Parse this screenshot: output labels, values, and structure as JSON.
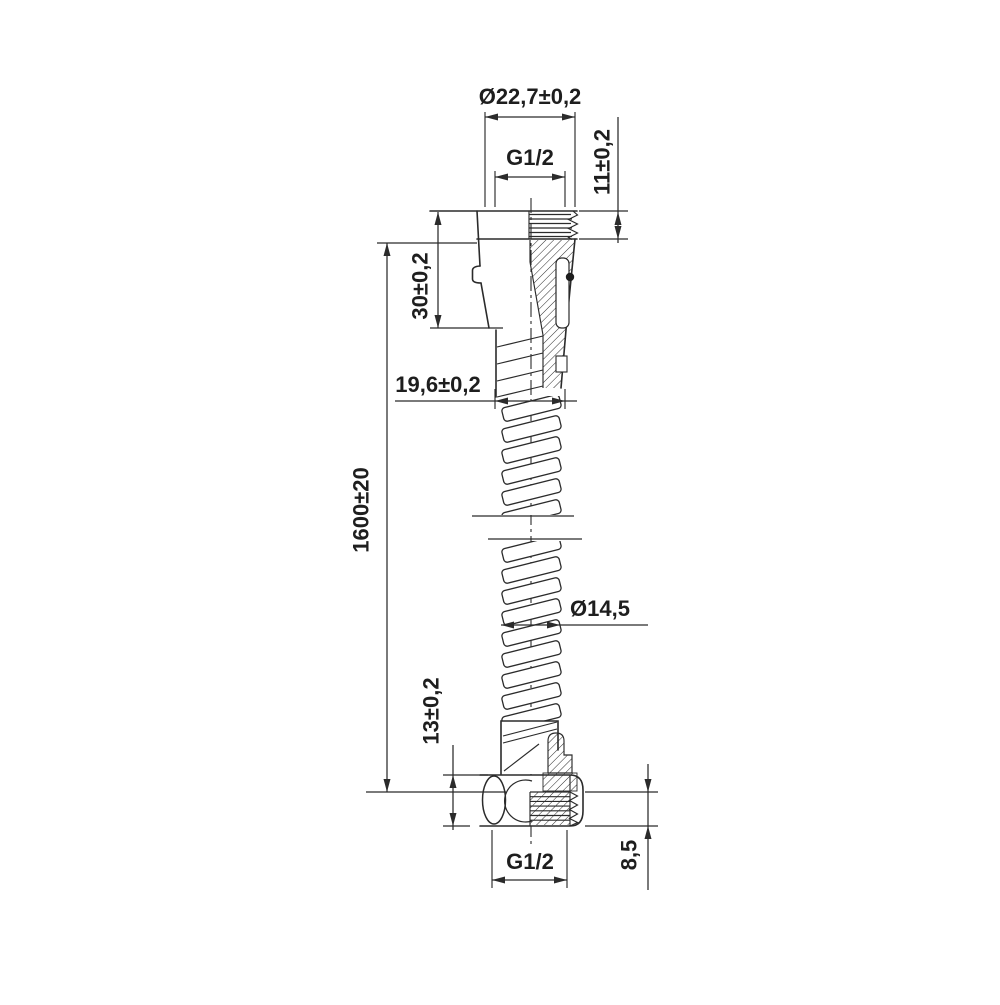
{
  "drawing": {
    "type": "technical-dimension-drawing",
    "subject": "flexible shower hose with end fittings, half-section view",
    "background_color": "#ffffff",
    "line_color": "#2b2b2b",
    "labels": {
      "top_outer_diameter": "Ø22,7±0,2",
      "top_thread": "G1/2",
      "top_thread_length": "11±0,2",
      "top_fitting_length": "30±0,2",
      "ferrule_diameter": "19,6±0,2",
      "overall_length": "1600±20",
      "hose_diameter": "Ø14,5",
      "bottom_fitting_height": "13±0,2",
      "bottom_thread": "G1/2",
      "bottom_thread_length": "8,5"
    }
  }
}
